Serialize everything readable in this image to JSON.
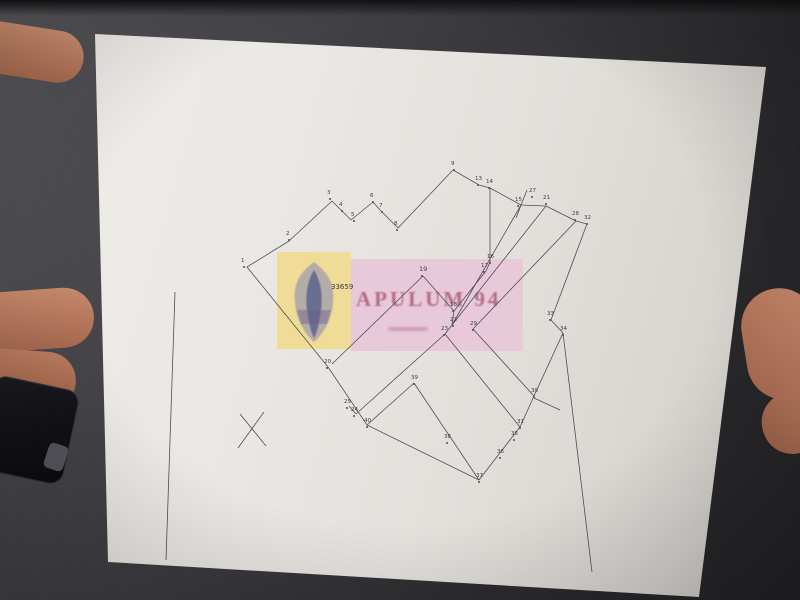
{
  "photo": {
    "background_color": "#3a3a3e",
    "paper_color": "#e7e3df",
    "ink_color": "#4a4a52"
  },
  "watermark": {
    "text": "APULUM 94",
    "emblem": "coat-of-arms",
    "yellow_box_color": "#f0db8c",
    "pink_box_color": "#e8c7d8",
    "text_color": "#a45270"
  },
  "table_headers": {
    "nr": "Nr. Pct.",
    "coord_group": "Coordonate pct.de contur",
    "x": "X [m]",
    "y": "Y [m]",
    "len": "Lungimi laturi D(i,i+1)"
  },
  "tables": [
    {
      "id": "t33659",
      "title": "Parcela (CF) 33659",
      "rows": [
        [
          "1",
          "351115.8130",
          "629464.3110",
          "31.36"
        ],
        [
          "2",
          "351134.2790",
          "629439.0730",
          "43.35"
        ],
        [
          "3",
          "351103.6760",
          "629410.6930",
          "7.51"
        ],
        [
          "4",
          "351097.4080",
          "629407.8410",
          "7.86"
        ],
        [
          "5",
          "351101.0990",
          "629400.3140",
          "22.09"
        ],
        [
          "6",
          "351120.1810",
          "629390.1970",
          "6.01"
        ],
        [
          "7",
          "351127.0590",
          "629387.9730",
          "17.56"
        ],
        [
          "8",
          "351140.8930",
          "629370.9930",
          "55.71"
        ],
        [
          "9",
          "351189.5750",
          "629343.7430",
          "20.93"
        ],
        [
          "10",
          "351207.1780",
          "629332.2930",
          "4.19"
        ],
        [
          "11",
          "351204.3780",
          "629329.3390",
          "3.18"
        ],
        [
          "12",
          "351202.1840",
          "629331.2750",
          "2.79"
        ],
        [
          "13",
          "351200.1340",
          "629333.8730",
          "1.63"
        ],
        [
          "14",
          "351201.0070",
          "629335.0730",
          "26.77"
        ],
        [
          "15",
          "351182.4400",
          "629354.7640",
          "52.11"
        ],
        [
          "16",
          "351176.3090",
          "629367.8930",
          "6.74"
        ],
        [
          "17",
          "351171.0950",
          "629364.7730",
          "35.89"
        ],
        [
          "18",
          "351147.8430",
          "629337.5630",
          "76.03"
        ],
        [
          "19",
          "351093.6150",
          "629390.4630",
          "62.28"
        ],
        [
          "20",
          "351051.8590",
          "629436.3910",
          "84.56"
        ]
      ],
      "footer": "S(CF)=3874mp  P=430.40m"
    },
    {
      "id": "t21125",
      "title": "Parcela (CF) 21125",
      "rows": [
        [
          "21",
          "351216.7790",
          "629373.6340",
          "129.08"
        ],
        [
          "22",
          "351133.6530",
          "629303.1290",
          "4.82"
        ],
        [
          "23",
          "351130.4540",
          "629299.7890",
          "4.83"
        ],
        [
          "24",
          "351075.8890",
          "629242.8110",
          "6.42"
        ],
        [
          "25",
          "351121.7230",
          "629286.2590",
          "9.68"
        ],
        [
          "26",
          "351118.1180",
          "629283.0460",
          "76.85"
        ],
        [
          "27",
          "351061.0040",
          "629231.5990",
          "80.13"
        ],
        [
          "15",
          "351182.4400",
          "629354.7640",
          "36.78"
        ],
        [
          "16",
          "351176.3090",
          "629367.8930",
          "9.74"
        ],
        [
          "17",
          "351171.0950",
          "629364.7730",
          "50.19"
        ],
        [
          "18",
          "351141.2480",
          "629314.6930",
          "71.32"
        ]
      ],
      "footer": "S(CF)=4305mp  P=603.19m"
    },
    {
      "id": "t21139",
      "title": "Parcela (CF) 21139",
      "rows": [
        [
          "32",
          "351206.1280",
          "629403.4930",
          "85.78"
        ],
        [
          "33",
          "351144.3990",
          "629385.9590",
          "13.37"
        ],
        [
          "34",
          "351127.4170",
          "629383.1040",
          "47.37"
        ],
        [
          "30",
          "351085.5770",
          "629360.9610",
          "57.33"
        ],
        [
          "29",
          "351131.6050",
          "629326.7170",
          "102.04"
        ],
        [
          "28",
          "351207.3640",
          "629395.0720",
          "8.03"
        ]
      ],
      "footer": "S(CF)=2785mp  P=293.82m"
    },
    {
      "id": "t21127",
      "title": "Parcela (CF) 21127",
      "rows": [
        [
          "28",
          "351207.3640",
          "629395.0720",
          "102.04"
        ],
        [
          "29",
          "351131.6050",
          "629326.7170",
          "57.33"
        ],
        [
          "30",
          "351085.5770",
          "629360.9610",
          "24.73"
        ],
        [
          "31",
          "351063.7350",
          "629349.3100",
          "83.09"
        ],
        [
          "23",
          "351130.4540",
          "629299.7890",
          "4.82"
        ],
        [
          "22",
          "351133.6530",
          "629303.1290",
          "108.00"
        ],
        [
          "21",
          "351216.7790",
          "629373.6340",
          "23.41"
        ]
      ],
      "footer": "S(CF)=3784mp  P=404.23m"
    },
    {
      "id": "t21126",
      "title": "Parcela (CF) 21126",
      "rows": [
        [
          "31",
          "351063.7350",
          "629349.3100",
          "7.11"
        ],
        [
          "35",
          "351057.4530",
          "629345.9760",
          "15.66"
        ],
        [
          "36",
          "351045.2120",
          "629336.2040",
          "18.69"
        ],
        [
          "37",
          "351031.8900",
          "629323.0920",
          "30.42"
        ],
        [
          "38",
          "351057.0100",
          "629305.9360",
          "46.08"
        ],
        [
          "39",
          "351093.2820",
          "629277.5220",
          "18.03"
        ],
        [
          "40",
          "351069.6770",
          "629247.7030",
          "7.91"
        ],
        [
          "24",
          "351075.8890",
          "629242.8110",
          "78.89"
        ],
        [
          "23",
          "351130.4540",
          "629299.7890",
          "83.09"
        ]
      ],
      "footer": "S(CF)=3794mp  P=325.88m"
    }
  ],
  "drawing": {
    "parcel_number_label": "33659",
    "points": [
      {
        "label": "1",
        "x": 241,
        "y": 262
      },
      {
        "label": "2",
        "x": 286,
        "y": 235
      },
      {
        "label": "3",
        "x": 327,
        "y": 194
      },
      {
        "label": "4",
        "x": 339,
        "y": 206
      },
      {
        "label": "5",
        "x": 351,
        "y": 216
      },
      {
        "label": "6",
        "x": 370,
        "y": 197
      },
      {
        "label": "7",
        "x": 379,
        "y": 207
      },
      {
        "label": "8",
        "x": 394,
        "y": 225
      },
      {
        "label": "9",
        "x": 451,
        "y": 165
      },
      {
        "label": "13",
        "x": 475,
        "y": 180
      },
      {
        "label": "14",
        "x": 486,
        "y": 183
      },
      {
        "label": "27",
        "x": 529,
        "y": 192
      },
      {
        "label": "15",
        "x": 515,
        "y": 201
      },
      {
        "label": "21",
        "x": 543,
        "y": 199
      },
      {
        "label": "28",
        "x": 572,
        "y": 215
      },
      {
        "label": "32",
        "x": 584,
        "y": 219
      },
      {
        "label": "16",
        "x": 487,
        "y": 258
      },
      {
        "label": "17",
        "x": 481,
        "y": 267
      },
      {
        "label": "19",
        "x": 419,
        "y": 271
      },
      {
        "label": "18",
        "x": 450,
        "y": 306
      },
      {
        "label": "22",
        "x": 450,
        "y": 321
      },
      {
        "label": "23",
        "x": 441,
        "y": 330
      },
      {
        "label": "29",
        "x": 470,
        "y": 325
      },
      {
        "label": "33",
        "x": 547,
        "y": 315
      },
      {
        "label": "34",
        "x": 560,
        "y": 330
      },
      {
        "label": "30",
        "x": 531,
        "y": 392
      },
      {
        "label": "31",
        "x": 517,
        "y": 423
      },
      {
        "label": "35",
        "x": 511,
        "y": 435
      },
      {
        "label": "36",
        "x": 497,
        "y": 453
      },
      {
        "label": "37",
        "x": 476,
        "y": 477
      },
      {
        "label": "38",
        "x": 444,
        "y": 438
      },
      {
        "label": "39",
        "x": 411,
        "y": 379
      },
      {
        "label": "40",
        "x": 364,
        "y": 422
      },
      {
        "label": "24",
        "x": 351,
        "y": 411
      },
      {
        "label": "25",
        "x": 344,
        "y": 403
      },
      {
        "label": "20",
        "x": 324,
        "y": 363
      }
    ],
    "segments": [
      [
        247,
        267,
        289,
        241
      ],
      [
        289,
        241,
        332,
        201
      ],
      [
        332,
        201,
        342,
        211
      ],
      [
        342,
        211,
        351,
        220
      ],
      [
        351,
        220,
        373,
        202
      ],
      [
        373,
        202,
        381,
        211
      ],
      [
        381,
        211,
        398,
        228
      ],
      [
        398,
        228,
        453,
        170
      ],
      [
        453,
        170,
        479,
        185
      ],
      [
        479,
        185,
        490,
        188
      ],
      [
        490,
        188,
        521,
        205
      ],
      [
        521,
        205,
        546,
        206
      ],
      [
        546,
        206,
        576,
        221
      ],
      [
        576,
        221,
        587,
        224
      ],
      [
        490,
        188,
        490,
        262
      ],
      [
        490,
        262,
        486,
        271
      ],
      [
        486,
        271,
        454,
        311
      ],
      [
        521,
        205,
        452,
        325
      ],
      [
        546,
        206,
        452,
        325
      ],
      [
        423,
        276,
        454,
        311
      ],
      [
        423,
        276,
        332,
        364
      ],
      [
        454,
        311,
        452,
        325
      ],
      [
        452,
        325,
        445,
        334
      ],
      [
        247,
        267,
        328,
        367
      ],
      [
        328,
        367,
        367,
        425
      ],
      [
        445,
        334,
        356,
        414
      ],
      [
        356,
        414,
        349,
        406
      ],
      [
        367,
        425,
        479,
        480
      ],
      [
        479,
        480,
        520,
        427
      ],
      [
        479,
        480,
        414,
        383
      ],
      [
        414,
        383,
        367,
        425
      ],
      [
        445,
        334,
        520,
        427
      ],
      [
        576,
        221,
        473,
        329
      ],
      [
        473,
        329,
        534,
        396
      ],
      [
        534,
        396,
        520,
        427
      ],
      [
        587,
        224,
        551,
        320
      ],
      [
        551,
        320,
        563,
        333
      ],
      [
        563,
        333,
        534,
        396
      ],
      [
        563,
        333,
        592,
        572
      ],
      [
        534,
        398,
        560,
        410
      ],
      [
        175,
        292,
        166,
        560
      ],
      [
        240,
        414,
        266,
        446
      ],
      [
        264,
        412,
        238,
        448
      ],
      [
        527,
        190,
        516,
        218
      ]
    ]
  }
}
